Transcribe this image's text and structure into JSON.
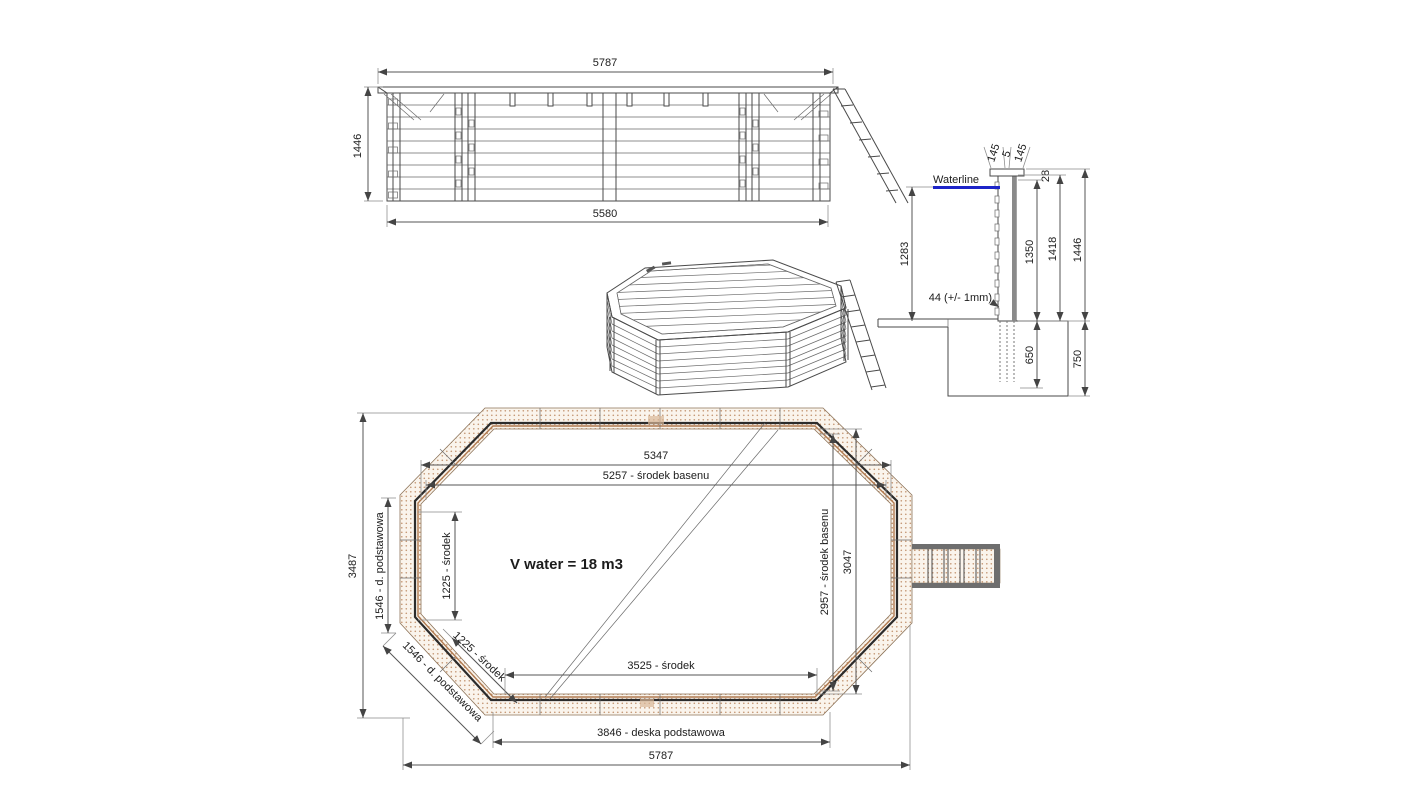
{
  "page": {
    "background": "#ffffff"
  },
  "colors": {
    "line": "#4a4a4a",
    "text": "#1c1c1c",
    "wall_hatch_dot": "#c49673",
    "wall_hatch_bg": "#faf4ec",
    "waterline_blue": "#1d24c8"
  },
  "elevation": {
    "dim_top": "5787",
    "dim_bottom": "5580",
    "dim_left": "1446"
  },
  "section": {
    "cap_dim_left": "145",
    "cap_dim_mid": "5",
    "cap_dim_right": "145",
    "dim_top_offset": "28",
    "waterline_label": "Waterline",
    "dim_water_depth": "1283",
    "wall_thickness_label": "44 (+/- 1mm)",
    "dim_inner_height": "1350",
    "dim_wall_height": "1418",
    "dim_total_height": "1446",
    "dim_below_ground": "650",
    "dim_foundation": "750"
  },
  "plan": {
    "dim_top_inner": "5347",
    "dim_top_center": "5257 - środek basenu",
    "dim_left_side_center": "1225 - środek",
    "dim_left_base": "1546 - d. podstawowa",
    "dim_overall_height": "3487",
    "dim_diag_center": "1225 - środek",
    "dim_diag_base": "1546 - d. podstawowa",
    "volume_label": "V water = 18 m3",
    "dim_right_center": "2957 - środek basenu",
    "dim_right_inner": "3047",
    "dim_bottom_center": "3525 - środek",
    "dim_bottom_base": "3846 - deska podstawowa",
    "dim_overall_width": "5787"
  }
}
